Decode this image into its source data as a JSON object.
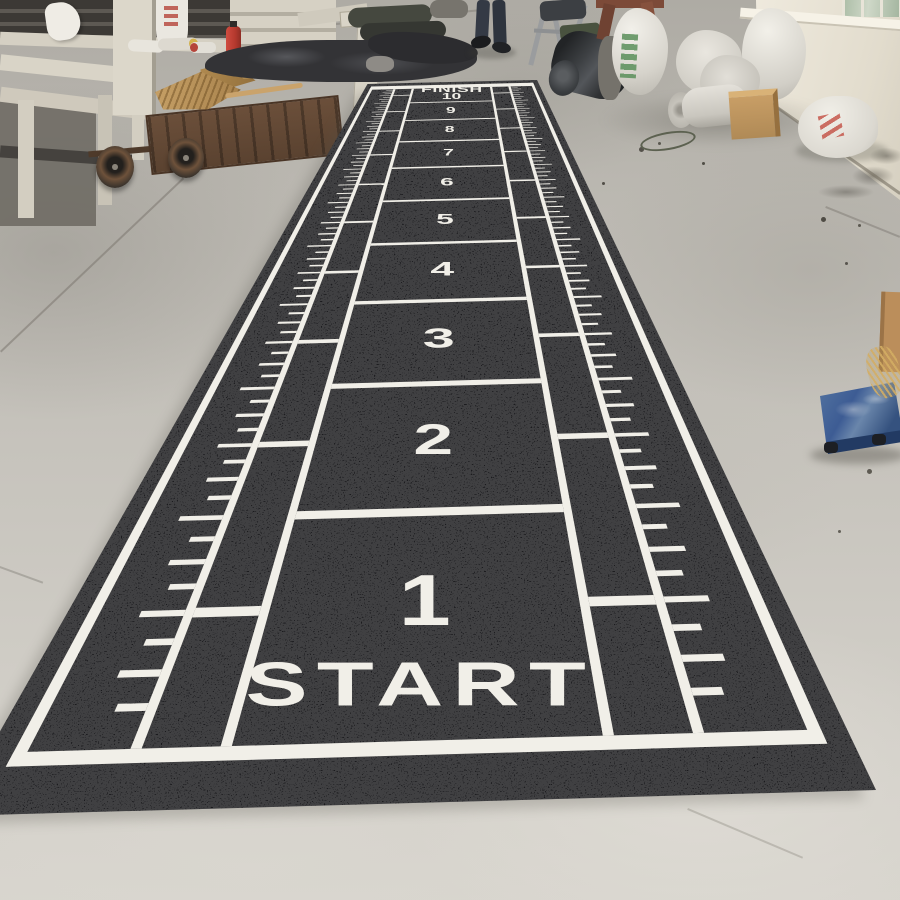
{
  "mat": {
    "finish_label": "FINISH",
    "finish_number": "10",
    "start_label": "START",
    "section_numbers": [
      "1",
      "2",
      "3",
      "4",
      "5",
      "6",
      "7",
      "8",
      "9",
      "10"
    ],
    "colors": {
      "turf": "#1b1b1e",
      "marking": "#f1efe8"
    }
  },
  "environment": {
    "floor_color": "#c6c3bc",
    "wall_color": "#e2dccd",
    "dolly_color": "#3d5c94",
    "cart_color": "#6e523b",
    "broom_color": "#a8824c",
    "sack_color": "#eceae3",
    "extinguisher_color": "#b5392e"
  }
}
